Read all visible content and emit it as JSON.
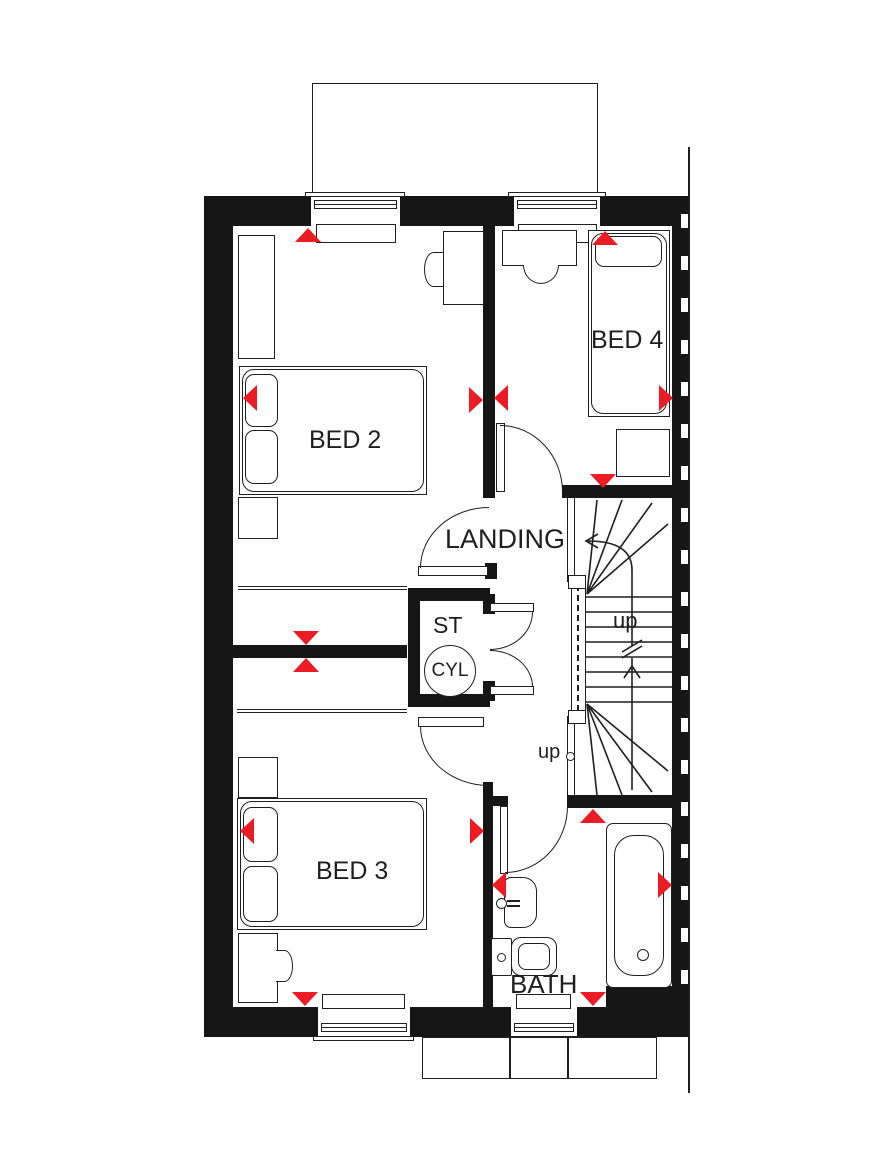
{
  "plan": {
    "title": "First floor plan",
    "labels": {
      "bed2": "BED 2",
      "bed3": "BED 3",
      "bed4": "BED 4",
      "landing": "LANDING",
      "store": "ST",
      "cylinder": "CYL",
      "bath": "BATH",
      "stairs_up": "up",
      "landing_up": "up"
    },
    "colors": {
      "wall": "#161616",
      "line": "#1f1f1f",
      "accent_red": "#ec1c24"
    },
    "icons": {
      "vent_arrow": "red solid triangle (window/door ventilation marker)",
      "walkline_arrow": "open chevron on stair walk line",
      "break_mark": "double zigzag break on stair walk line",
      "cylinder": "circle labelled CYL",
      "door_swing": "quarter-circle arc"
    }
  }
}
